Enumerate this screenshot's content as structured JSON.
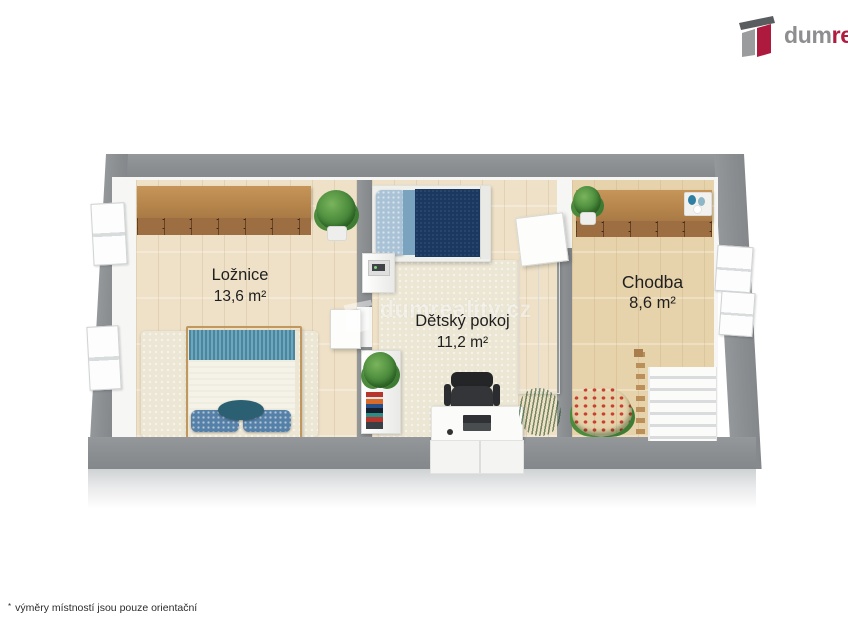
{
  "brand": {
    "logo_text_gray": "dum",
    "logo_text_red": "real",
    "color_gray": "#8e8e90",
    "color_red": "#b01b40"
  },
  "watermark": {
    "text": "dumreality.cz"
  },
  "rooms": [
    {
      "name": "Ložnice",
      "area": "13,6 m²"
    },
    {
      "name": "Dětský pokoj",
      "area": "11,2 m²"
    },
    {
      "name": "Chodba",
      "area": "8,6 m²"
    }
  ],
  "footnote": {
    "marker": "*",
    "text": "výměry místností jsou pouze orientační"
  }
}
